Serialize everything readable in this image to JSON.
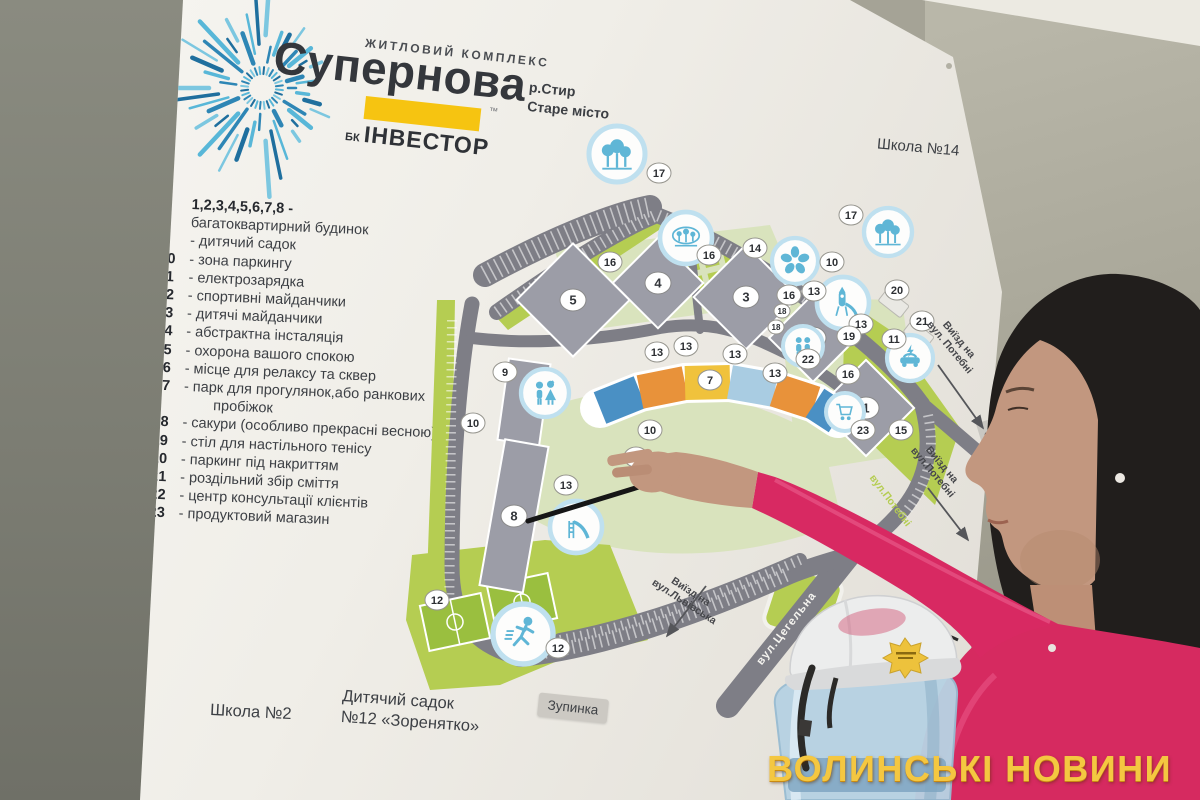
{
  "watermark": {
    "text": "ВОЛИНСЬКІ НОВИНИ",
    "color": "#f4c741"
  },
  "board": {
    "logo": {
      "subtitle": "ЖИТЛОВИЙ КОМПЛЕКС",
      "title": "Супернова",
      "trademark": "™",
      "developer_prefix": "БК",
      "developer_name": "ІНВЕСТОР",
      "accent_yellow": "#f6c411",
      "ray_colors": [
        "#2e86b5",
        "#58b7d8",
        "#1f6f9e",
        "#7cc7e0"
      ]
    },
    "location_lines": [
      "р.Стир",
      "Старе місто"
    ],
    "label_school14": "Школа №14",
    "legend_items": [
      {
        "num": "1,2,3,4,5,6,7,8 -",
        "text": "багатоквартирний будинок",
        "block": true
      },
      {
        "num": "9",
        "text": "дитячий садок"
      },
      {
        "num": "10",
        "text": "зона паркингу"
      },
      {
        "num": "11",
        "text": "електрозарядка"
      },
      {
        "num": "12",
        "text": "спортивні майданчики"
      },
      {
        "num": "13",
        "text": "дитячі майданчики"
      },
      {
        "num": "14",
        "text": "абстрактна інсталяція"
      },
      {
        "num": "15",
        "text": "охорона вашого спокою"
      },
      {
        "num": "16",
        "text": "місце для релаксу та сквер"
      },
      {
        "num": "17",
        "text": "парк для прогулянок,або ранкових пробіжок"
      },
      {
        "num": "18",
        "text": "сакури (особливо прекрасні весною)"
      },
      {
        "num": "19",
        "text": "стіл для настільного тенісу"
      },
      {
        "num": "20",
        "text": "паркинг під накриттям"
      },
      {
        "num": "21",
        "text": "роздільний збір сміття"
      },
      {
        "num": "22",
        "text": "центр консультації клієнтів"
      },
      {
        "num": "23",
        "text": "продуктовий магазин"
      }
    ],
    "bottom_labels": {
      "school2": "Школа №2",
      "kindergarten_line1": "Дитячий садок",
      "kindergarten_line2": "№12 «Зоренятко»",
      "bus_stop": "Зупинка"
    }
  },
  "map": {
    "colors": {
      "lime": "#b5cd52",
      "pale_green": "#d9e3bd",
      "road": "#7e7e86",
      "building": "#9c9da7",
      "icon_blue": "#5fb6d6",
      "icon_ring": "#bfe0ef",
      "facade": [
        "#4a90c4",
        "#e8923a",
        "#f0c23c",
        "#a9cce2",
        "#e8923a",
        "#4a90c4"
      ]
    },
    "buildings": [
      {
        "label": "5",
        "x": 573,
        "y": 300,
        "w": 80,
        "h": 80,
        "rot": 45
      },
      {
        "label": "4",
        "x": 658,
        "y": 283,
        "w": 64,
        "h": 64,
        "rot": 45
      },
      {
        "label": "3",
        "x": 746,
        "y": 297,
        "w": 74,
        "h": 74,
        "rot": 45
      },
      {
        "label": "2",
        "x": 813,
        "y": 338,
        "w": 62,
        "h": 62,
        "rot": 45
      },
      {
        "label": "1",
        "x": 866,
        "y": 408,
        "w": 68,
        "h": 68,
        "rot": 45
      },
      {
        "label": "",
        "x": 524,
        "y": 402,
        "w": 42,
        "h": 82,
        "rot": 8
      },
      {
        "label": "8",
        "x": 514,
        "y": 516,
        "w": 44,
        "h": 148,
        "rot": 10
      }
    ],
    "building7": {
      "points": [
        [
          600,
          408
        ],
        [
          640,
          392
        ],
        [
          685,
          383
        ],
        [
          730,
          382
        ],
        [
          775,
          390
        ],
        [
          815,
          403
        ],
        [
          838,
          418
        ]
      ]
    },
    "badges": [
      {
        "n": "17",
        "x": 659,
        "y": 173
      },
      {
        "n": "17",
        "x": 851,
        "y": 215
      },
      {
        "n": "16",
        "x": 610,
        "y": 262
      },
      {
        "n": "16",
        "x": 709,
        "y": 255
      },
      {
        "n": "14",
        "x": 755,
        "y": 248
      },
      {
        "n": "10",
        "x": 832,
        "y": 262
      },
      {
        "n": "13",
        "x": 814,
        "y": 291
      },
      {
        "n": "16",
        "x": 789,
        "y": 295
      },
      {
        "n": "18",
        "x": 782,
        "y": 311,
        "small": true
      },
      {
        "n": "18",
        "x": 776,
        "y": 327,
        "small": true
      },
      {
        "n": "13",
        "x": 861,
        "y": 324
      },
      {
        "n": "19",
        "x": 849,
        "y": 336
      },
      {
        "n": "20",
        "x": 897,
        "y": 290
      },
      {
        "n": "21",
        "x": 922,
        "y": 321
      },
      {
        "n": "11",
        "x": 894,
        "y": 339
      },
      {
        "n": "22",
        "x": 808,
        "y": 359
      },
      {
        "n": "16",
        "x": 848,
        "y": 374
      },
      {
        "n": "15",
        "x": 901,
        "y": 430
      },
      {
        "n": "13",
        "x": 657,
        "y": 352
      },
      {
        "n": "13",
        "x": 686,
        "y": 346
      },
      {
        "n": "13",
        "x": 735,
        "y": 354
      },
      {
        "n": "13",
        "x": 775,
        "y": 373
      },
      {
        "n": "23",
        "x": 863,
        "y": 430
      },
      {
        "n": "10",
        "x": 650,
        "y": 430
      },
      {
        "n": "16",
        "x": 636,
        "y": 457
      },
      {
        "n": "10",
        "x": 473,
        "y": 423
      },
      {
        "n": "9",
        "x": 505,
        "y": 372
      },
      {
        "n": "13",
        "x": 566,
        "y": 485
      },
      {
        "n": "12",
        "x": 437,
        "y": 600
      },
      {
        "n": "12",
        "x": 558,
        "y": 648
      },
      {
        "n": "7",
        "x": 710,
        "y": 380
      }
    ],
    "icons": [
      {
        "icon": "trees-icon",
        "x": 617,
        "y": 154,
        "r": 28
      },
      {
        "icon": "trees-icon",
        "x": 888,
        "y": 232,
        "r": 24
      },
      {
        "icon": "park-icon",
        "x": 686,
        "y": 238,
        "r": 26
      },
      {
        "icon": "flower-icon",
        "x": 795,
        "y": 261,
        "r": 23
      },
      {
        "icon": "rocket-slide-icon",
        "x": 843,
        "y": 303,
        "r": 26
      },
      {
        "icon": "people-icon",
        "x": 803,
        "y": 346,
        "r": 20
      },
      {
        "icon": "ev-charging-icon",
        "x": 910,
        "y": 358,
        "r": 23
      },
      {
        "icon": "cart-icon",
        "x": 845,
        "y": 412,
        "r": 19
      },
      {
        "icon": "kids-icon",
        "x": 545,
        "y": 393,
        "r": 24
      },
      {
        "icon": "slide-icon",
        "x": 576,
        "y": 527,
        "r": 26
      },
      {
        "icon": "running-icon",
        "x": 523,
        "y": 634,
        "r": 30
      }
    ],
    "road_labels": [
      {
        "lines": [
          "Виїзд на",
          "вул. Потебні"
        ],
        "x": 955,
        "y": 343,
        "rot": 50,
        "style": "dark"
      },
      {
        "lines": [
          "Виїзд на",
          "вул.Потебні"
        ],
        "x": 938,
        "y": 468,
        "rot": 50,
        "style": "dark"
      },
      {
        "lines": [
          "Виїзд на",
          "вул.Львівська"
        ],
        "x": 688,
        "y": 596,
        "rot": 33,
        "style": "dark"
      },
      {
        "lines": [
          "вул.Цегельна"
        ],
        "x": 786,
        "y": 628,
        "rot": -52,
        "style": "white"
      },
      {
        "lines": [
          "вул.Потебні"
        ],
        "x": 891,
        "y": 500,
        "rot": 53,
        "style": "green"
      },
      {
        "lines": [
          "Зупинка"
        ],
        "x": 994,
        "y": 452,
        "rot": 73,
        "style": "boxed"
      }
    ],
    "arrows": [
      {
        "x1": 938,
        "y1": 365,
        "x2": 983,
        "y2": 428
      },
      {
        "x1": 928,
        "y1": 488,
        "x2": 968,
        "y2": 540
      },
      {
        "x1": 706,
        "y1": 586,
        "x2": 667,
        "y2": 636
      }
    ]
  },
  "scene_colors": {
    "blazer_pink": "#d62a60",
    "hair": "#211e1c",
    "skin": "#c2977f",
    "helmet": "#eceded",
    "bottle_blue": "#b7d2e3",
    "wall_gray": "#8a8b80"
  }
}
